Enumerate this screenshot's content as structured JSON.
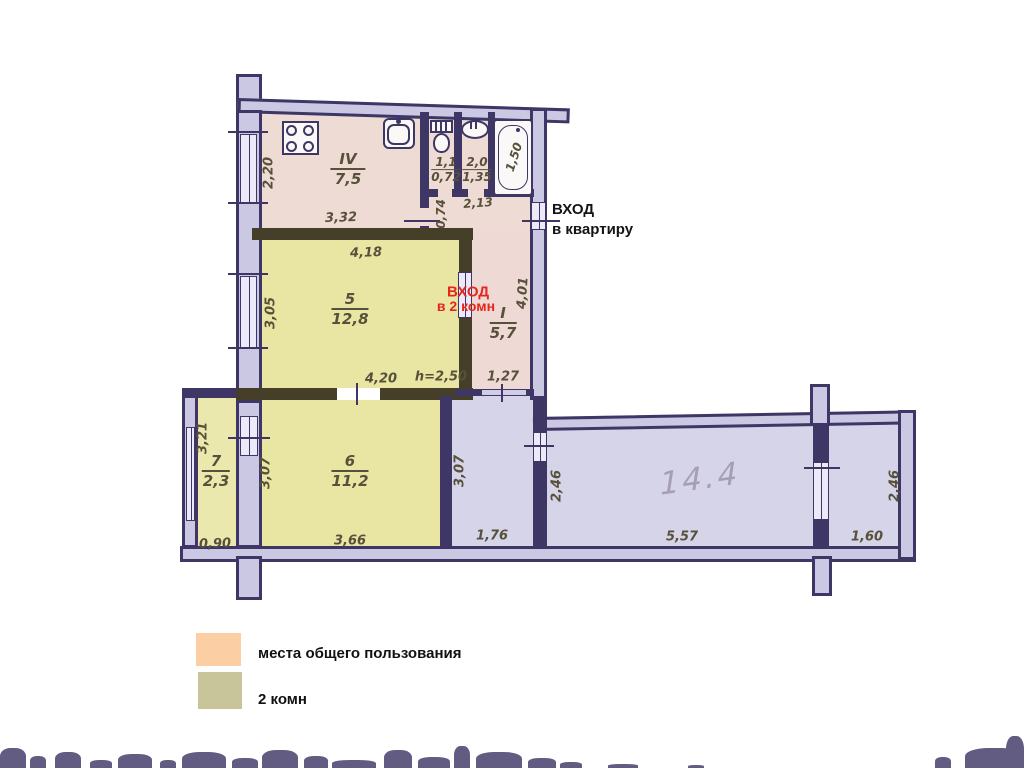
{
  "plan": {
    "entrance_apartment": {
      "line1": "ВХОД",
      "line2": "в квартиру"
    },
    "entrance_rooms": {
      "line1": "ВХОД",
      "line2": "в 2 комн"
    },
    "handwritten_area": "14.4",
    "rooms": {
      "kitchen": {
        "num": "IV",
        "area": "7,5"
      },
      "wc": {
        "top": "1,1",
        "bottom": "0,72"
      },
      "bath": {
        "top": "2,0",
        "bottom": "1,35"
      },
      "hall": {
        "num": "I",
        "area": "5,7"
      },
      "room5": {
        "num": "5",
        "area": "12,8"
      },
      "room6": {
        "num": "6",
        "area": "11,2"
      },
      "room7": {
        "num": "7",
        "area": "2,3"
      }
    },
    "dims": {
      "kitchen_width": "2,20",
      "kitchen_length": "3,32",
      "tub_length": "1,50",
      "passage_width": "0,74",
      "bath_length": "2,13",
      "room5_top": "4,18",
      "room5_left": "3,05",
      "room5_bottom": "4,20",
      "ceiling_height": "h=2,50",
      "hall_height": "4,01",
      "hall_bottom": "1,27",
      "room7_left": "3,21",
      "room7_bottom": "0,90",
      "room6_left": "3,07",
      "room6_bottom": "3,66",
      "corridor_left": "3,07",
      "corridor_bottom": "1,76",
      "corridor_width": "2,46",
      "bigroom_bottom": "5,57",
      "right_width": "2,46",
      "right_bottom": "1,60"
    }
  },
  "legend": {
    "items": [
      {
        "label": "места общего пользования",
        "color": "#fbcfa3"
      },
      {
        "label": "2 комн",
        "color": "#c9c59b"
      }
    ]
  }
}
